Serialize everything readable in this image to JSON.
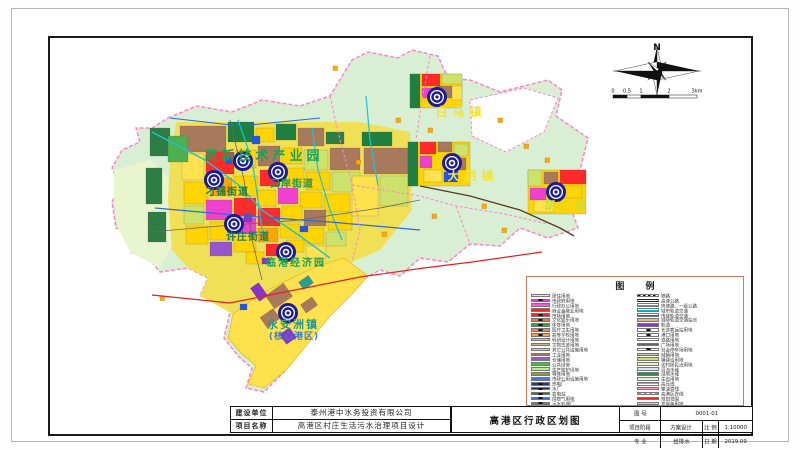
{
  "window": {
    "title": "高港区行政区划图"
  },
  "map": {
    "background_color": "#d8efd3",
    "boundary_color": "#ff85c8",
    "labels": [
      {
        "text": "白马镇",
        "x": 461,
        "y": 116,
        "color": "#f4e33a",
        "size": 12,
        "ls": 5
      },
      {
        "text": "大泗镇",
        "x": 473,
        "y": 180,
        "color": "#f4e33a",
        "size": 12,
        "ls": 5
      },
      {
        "text": "胡庄镇",
        "x": 567,
        "y": 209,
        "color": "#cddc39",
        "size": 11,
        "ls": 4
      },
      {
        "text": "高新技术产业园",
        "x": 264,
        "y": 160,
        "color": "#1fa055",
        "size": 13,
        "ls": 4
      },
      {
        "text": "刁铺街道",
        "x": 227,
        "y": 195,
        "color": "#1f7a46",
        "size": 10,
        "ls": 1
      },
      {
        "text": "口岸街道",
        "x": 292,
        "y": 187,
        "color": "#23985a",
        "size": 10,
        "ls": 1
      },
      {
        "text": "许庄街道",
        "x": 248,
        "y": 240,
        "color": "#1f7a5a",
        "size": 10,
        "ls": 1
      },
      {
        "text": "临港经济园",
        "x": 296,
        "y": 266,
        "color": "#1fa055",
        "size": 10,
        "ls": 2
      },
      {
        "text": "永安洲镇",
        "x": 293,
        "y": 328,
        "color": "#2a9a8f",
        "size": 11,
        "ls": 2
      },
      {
        "text": "(核心港区)",
        "x": 294,
        "y": 339,
        "color": "#3a7fd0",
        "size": 9,
        "ls": 1
      }
    ],
    "town_markers": [
      [
        437,
        97
      ],
      [
        452,
        163
      ],
      [
        556,
        192
      ],
      [
        243,
        161
      ],
      [
        214,
        180
      ],
      [
        278,
        172
      ],
      [
        234,
        224
      ],
      [
        286,
        252
      ],
      [
        288,
        313
      ]
    ]
  },
  "compass": {
    "north_label": "N"
  },
  "scalebar": {
    "ticks": [
      "0",
      "0.5",
      "1",
      "2",
      "3km"
    ]
  },
  "legend": {
    "title": "图 例",
    "left": [
      {
        "label": "居住用地",
        "color": "#ffff33",
        "type": "box"
      },
      {
        "label": "市政府用地",
        "color": "#ff33cc",
        "type": "box-sym"
      },
      {
        "label": "行政办公用地",
        "color": "#ff55dd",
        "type": "box"
      },
      {
        "label": "商业金融业用地",
        "color": "#ff2222",
        "type": "box"
      },
      {
        "label": "市场用地",
        "color": "#ff2222",
        "type": "box-sym"
      },
      {
        "label": "文化娱乐用地",
        "color": "#ff6a4d",
        "type": "box-sym"
      },
      {
        "label": "体育用地",
        "color": "#22aa44",
        "type": "box-sym"
      },
      {
        "label": "医疗卫生用地",
        "color": "#ff7766",
        "type": "box-sym"
      },
      {
        "label": "高等学校用地",
        "color": "#ffa042",
        "type": "box-sym"
      },
      {
        "label": "科研设计用地",
        "color": "#ffb060",
        "type": "box"
      },
      {
        "label": "文物古迹用地",
        "color": "#d2b48c",
        "type": "box"
      },
      {
        "label": "其它公共设施用地",
        "color": "#ffb6c1",
        "type": "box"
      },
      {
        "label": "工业用地",
        "color": "#a8795a",
        "type": "box"
      },
      {
        "label": "仓储用地",
        "color": "#9955cc",
        "type": "box"
      },
      {
        "label": "公共绿地",
        "color": "#33cc33",
        "type": "box"
      },
      {
        "label": "生产防护绿地",
        "color": "#bbee88",
        "type": "box"
      },
      {
        "label": "特殊用地",
        "color": "#8f9a3a",
        "type": "box"
      },
      {
        "label": "市政公用设施用地",
        "color": "#4477ee",
        "type": "box"
      },
      {
        "label": "热电厂",
        "color": "#223a8f",
        "type": "box-sym"
      },
      {
        "label": "水厂",
        "color": "#30343a",
        "type": "box-sym"
      },
      {
        "label": "变电站",
        "color": "#55585e",
        "type": "box-sym"
      },
      {
        "label": "供燃气用地",
        "color": "#3a6fd8",
        "type": "box-sym"
      },
      {
        "label": "污水处理厂",
        "color": "#2a9d8f",
        "type": "box-sym"
      },
      {
        "label": "垃圾处理厂",
        "color": "#2a9d8f",
        "type": "box-sym"
      }
    ],
    "right": [
      {
        "label": "铁路",
        "color": "#111111",
        "type": "rail"
      },
      {
        "label": "高速公路",
        "color": "#222222",
        "type": "road2"
      },
      {
        "label": "快速路、一级公路",
        "color": "#888888",
        "type": "line"
      },
      {
        "label": "城市轨道交通",
        "color": "#00bcd4",
        "type": "line"
      },
      {
        "label": "市域轨道交通",
        "color": "#3355dd",
        "type": "line"
      },
      {
        "label": "城际轨道交通站点",
        "color": "#d8c080",
        "type": "box"
      },
      {
        "label": "航道",
        "color": "#8833cc",
        "type": "line-thick"
      },
      {
        "label": "长途客运站用地",
        "color": "#ffffff",
        "type": "box-sym"
      },
      {
        "label": "港口用地",
        "color": "#ffffff",
        "type": "box-sym"
      },
      {
        "label": "道路用地",
        "color": "#ffffff",
        "type": "box"
      },
      {
        "label": "广场用地",
        "color": "#666666",
        "type": "box"
      },
      {
        "label": "社会停车场用地",
        "color": "#ffffff",
        "type": "box-sym"
      },
      {
        "label": "城镇用地",
        "color": "#bfbfbf",
        "type": "box"
      },
      {
        "label": "镇建设用地",
        "color": "#cde26a",
        "type": "box"
      },
      {
        "label": "农村居民点用地",
        "color": "#f5f0c8",
        "type": "box"
      },
      {
        "label": "河流水域",
        "color": "#cfe8f7",
        "type": "box"
      },
      {
        "label": "湿地水域",
        "color": "#2e8b57",
        "type": "box"
      },
      {
        "label": "生态用地",
        "color": "#e4f3d2",
        "type": "box"
      },
      {
        "label": "高压线",
        "color": "#ff7799",
        "type": "line"
      },
      {
        "label": "输油管线",
        "color": "#ff99bb",
        "type": "line"
      },
      {
        "label": "高港区界线",
        "color": "#ff66aa",
        "type": "dash"
      },
      {
        "label": "规划范围",
        "color": "#ee2222",
        "type": "line"
      },
      {
        "label": "发展备用地",
        "color": "#e6c8e6",
        "type": "box"
      }
    ]
  },
  "titleblock": {
    "left_rows": [
      {
        "label": "建设单位",
        "value": "泰州港中水务投资有限公司"
      },
      {
        "label": "项目名称",
        "value": "高港区村庄生活污水治理项目设计"
      }
    ],
    "center_title": "高港区行政区划图",
    "right": {
      "r1_label": "图  号",
      "r1_value": "0001-01",
      "r2a": "项目阶段",
      "r2b": "方案设计",
      "r2c": "比 例",
      "r2d": "1:10000",
      "r3a": "专  业",
      "r3b": "给排水",
      "r3c": "日 期",
      "r3d": "2019.09"
    }
  }
}
